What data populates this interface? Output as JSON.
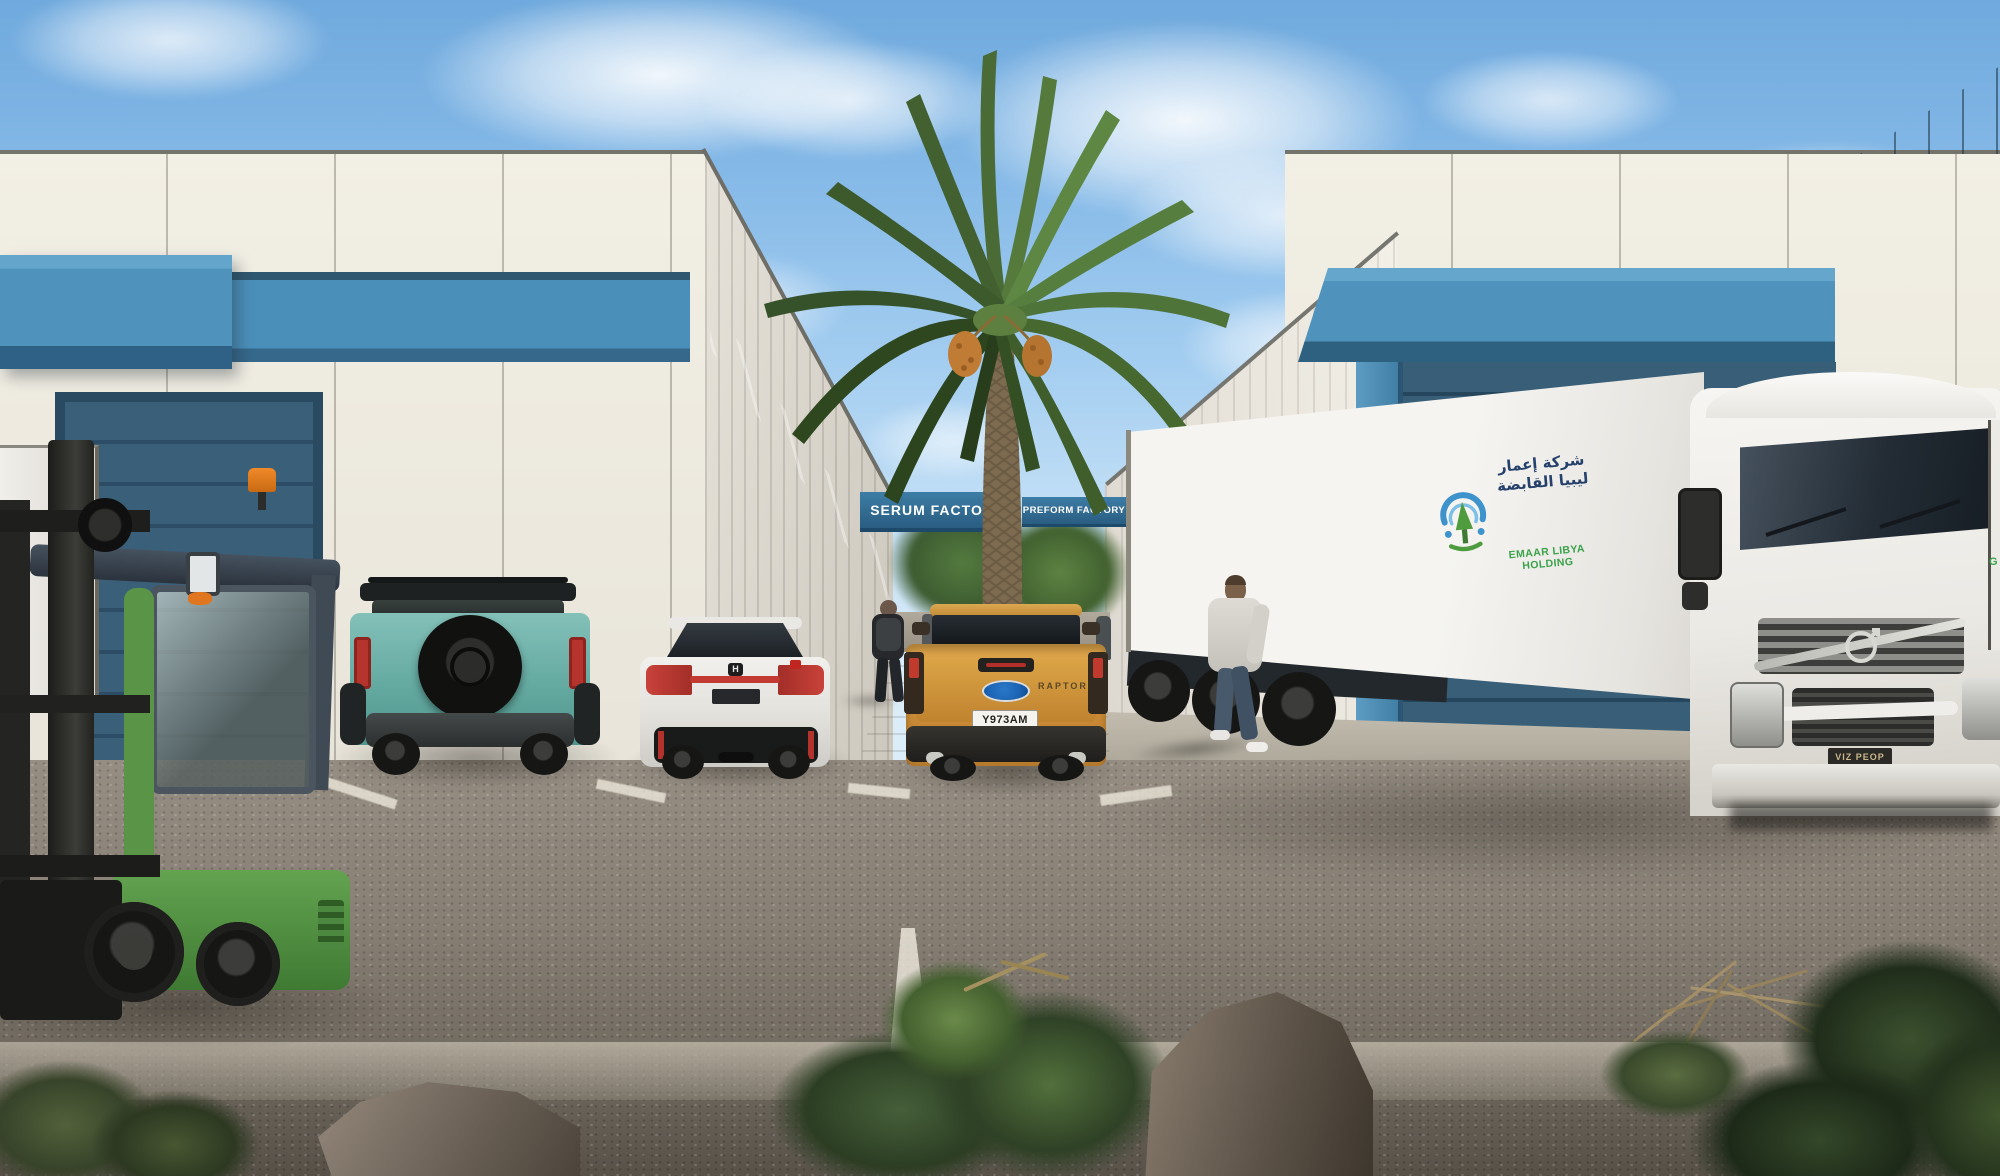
{
  "scene_title": "Industrial factory park exterior rendering",
  "signs": {
    "serum": "SERUM FACTORY",
    "preform": "PREFORM FACTORY"
  },
  "trailer": {
    "arabic": "شركة إعمار ليبيا القابضة",
    "company": "EMAAR LIBYA HOLDING"
  },
  "neighbor": {
    "fragment": "G"
  },
  "pickup": {
    "plate": "Y973AM",
    "badge": "RAPTOR"
  },
  "semi": {
    "plate": "VIZ PEOP"
  },
  "civic": {
    "h_badge": "H"
  },
  "palette": {
    "sky_top": "#6fa9dd",
    "building_white": "#edeade",
    "accent_blue_band": "#4f93bd",
    "sign_blue": "#2e6d95",
    "dock_door_blue": "#33566f",
    "logo_green": "#3aa24a",
    "logo_navy": "#24406b",
    "pickup_gold": "#d0913a",
    "bronco_teal": "#64aaa1",
    "forklift_green": "#5a9447",
    "asphalt": "#8a8379"
  }
}
